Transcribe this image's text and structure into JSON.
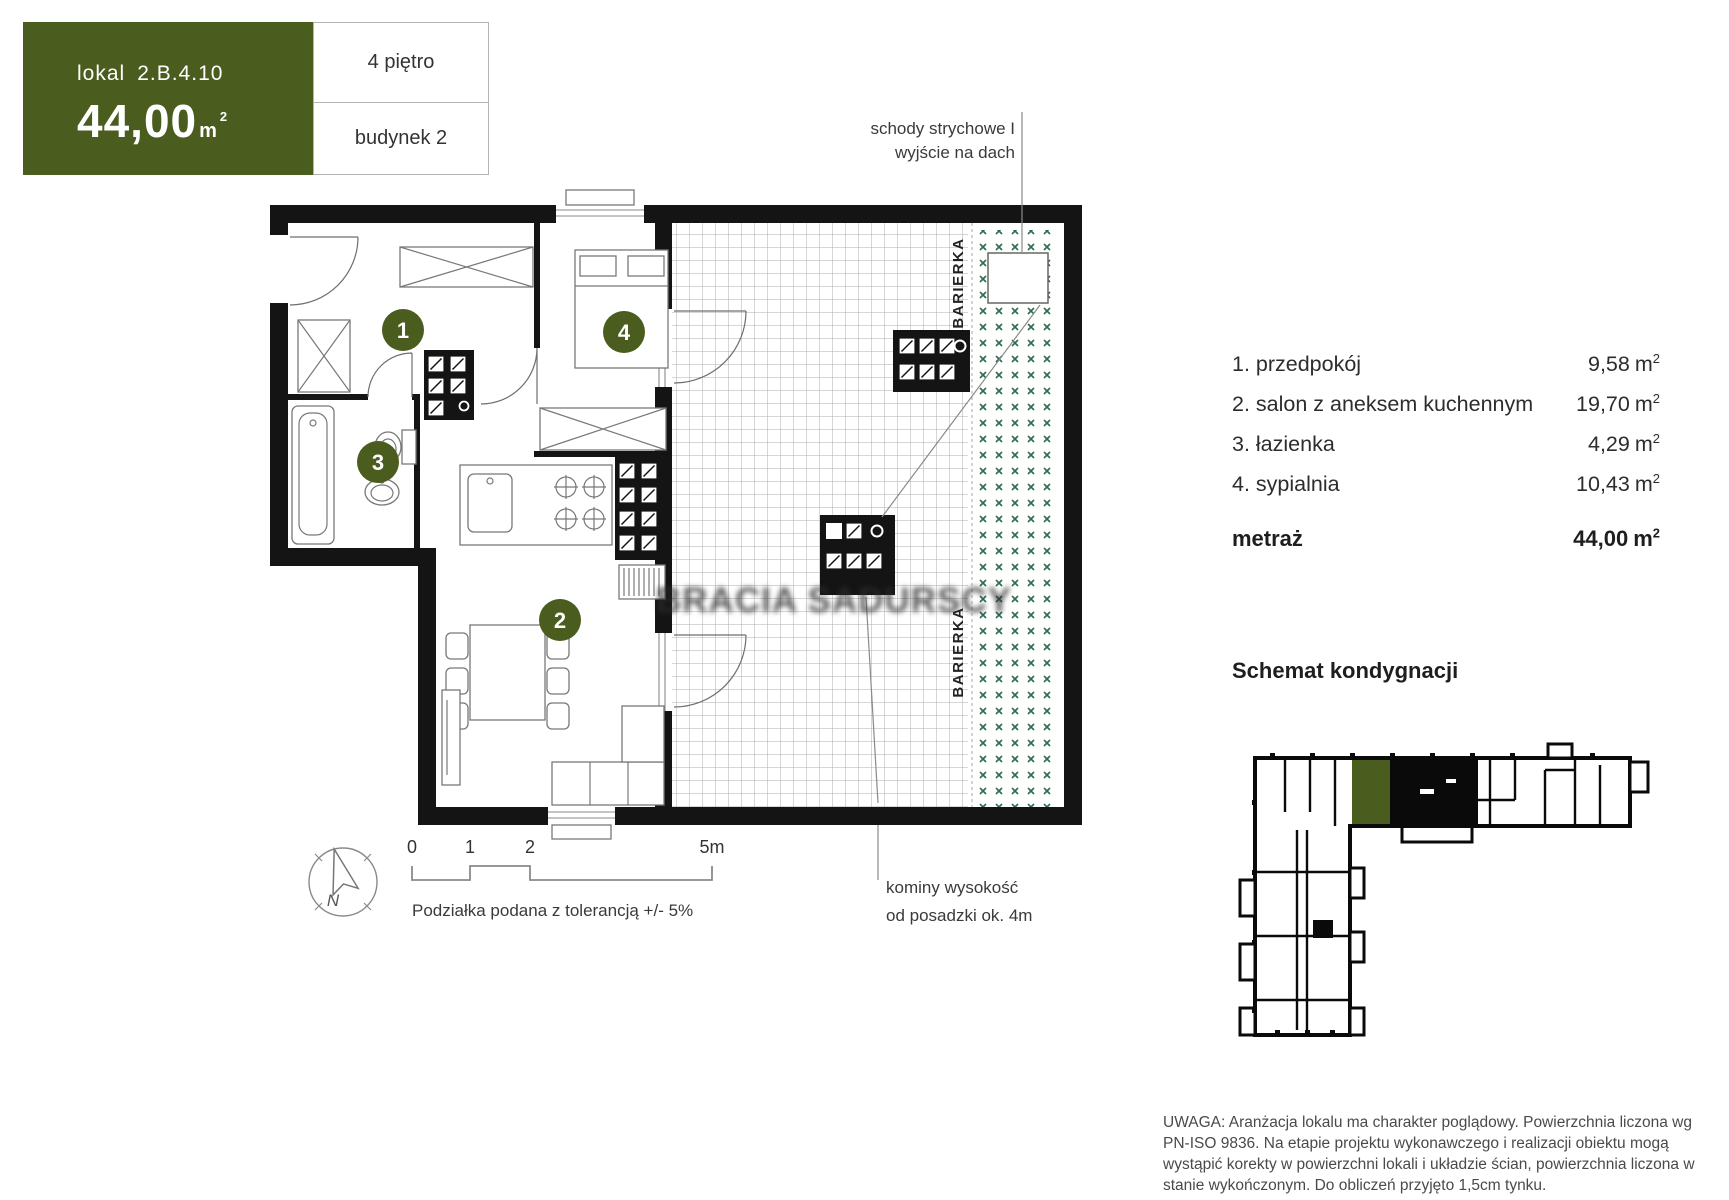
{
  "colors": {
    "accent": "#4a5c1e",
    "grid": "#a8aeb4",
    "dots": "#2e6b4c"
  },
  "header": {
    "lokal_label": "lokal",
    "lokal_number": "2.B.4.10",
    "area_value": "44,00",
    "area_unit_base": "m",
    "area_sup": "2",
    "floor": "4 piętro",
    "building": "budynek 2"
  },
  "plan": {
    "badges": [
      "1",
      "2",
      "3",
      "4"
    ],
    "attic_label_line1": "schody strychowe I",
    "attic_label_line2": "wyjście na dach",
    "chimney_label_line1": "kominy wysokość",
    "chimney_label_line2": "od posadzki ok. 4m",
    "barrier_label": "BARIERKA",
    "watermark": "BRACIA SADURSCY",
    "compass_label": "N",
    "scale_ticks": [
      "0",
      "1",
      "2",
      "5m"
    ],
    "scale_note": "Podziałka podana z tolerancją +/- 5%"
  },
  "rooms": [
    {
      "name": "1. przedpokój",
      "value": "9,58",
      "unit": "m",
      "sup": "2"
    },
    {
      "name": "2. salon z aneksem kuchennym",
      "value": "19,70",
      "unit": "m",
      "sup": "2"
    },
    {
      "name": "3. łazienka",
      "value": "4,29",
      "unit": "m",
      "sup": "2"
    },
    {
      "name": "4. sypialnia",
      "value": "10,43",
      "unit": "m",
      "sup": "2"
    }
  ],
  "total": {
    "label": "metraż",
    "value": "44,00",
    "unit": "m",
    "sup": "2"
  },
  "schematic": {
    "title": "Schemat kondygnacji"
  },
  "disclaimer": "UWAGA: Aranżacja lokalu ma charakter poglądowy. Powierzchnia liczona wg PN-ISO 9836. Na etapie projektu wykonawczego i realizacji obiektu mogą wystąpić korekty w powierzchni lokali i układzie ścian, powierzchnia liczona w stanie wykończonym. Do obliczeń przyjęto 1,5cm tynku."
}
